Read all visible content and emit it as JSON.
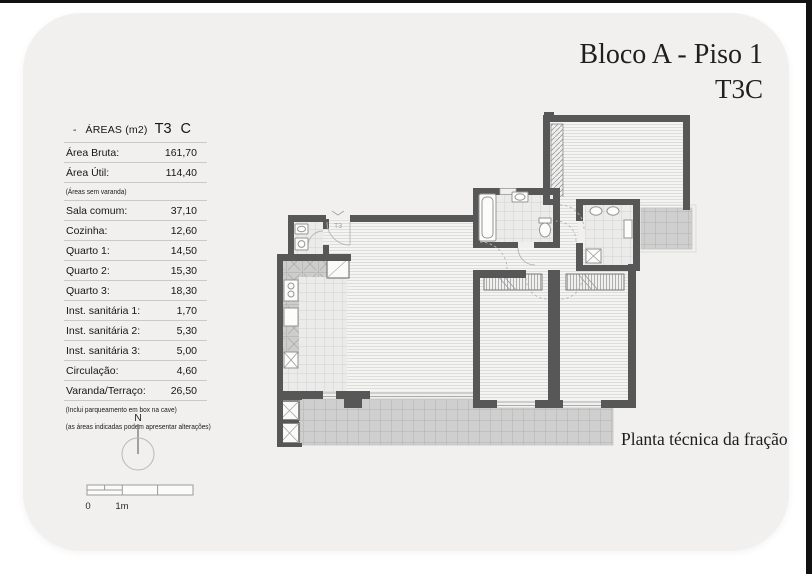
{
  "header": {
    "title_line1": "Bloco A - Piso 1",
    "title_line2": "T3C"
  },
  "areas_table": {
    "dash": "-",
    "title": "ÁREAS (m2)",
    "type_code": "T3",
    "type_letter": "C",
    "rows": [
      {
        "label": "Área Bruta:",
        "value": "161,70"
      },
      {
        "label": "Área Útil:",
        "value": "114,40"
      },
      {
        "note": "(Áreas sem varanda)"
      },
      {
        "label": "Sala comum:",
        "value": "37,10"
      },
      {
        "label": "Cozinha:",
        "value": "12,60"
      },
      {
        "label": "Quarto 1:",
        "value": "14,50"
      },
      {
        "label": "Quarto 2:",
        "value": "15,30"
      },
      {
        "label": "Quarto 3:",
        "value": "18,30"
      },
      {
        "label": "Inst. sanitária 1:",
        "value": "1,70"
      },
      {
        "label": "Inst. sanitária 2:",
        "value": "5,30"
      },
      {
        "label": "Inst. sanitária 3:",
        "value": "5,00"
      },
      {
        "label": "Circulação:",
        "value": "4,60"
      },
      {
        "label": "Varanda/Terraço:",
        "value": "26,50"
      },
      {
        "note": "(Inclui parqueamento em box na cave)"
      },
      {
        "note": "(as áreas indicadas podem apresentar alterações)"
      }
    ]
  },
  "compass": {
    "north_label": "N"
  },
  "scalebar": {
    "zero_label": "0",
    "meter_label": "1m"
  },
  "plan": {
    "caption": "Planta técnica da fração",
    "entrance_label": "T3"
  },
  "colors": {
    "card_background": "#f1f0ef",
    "wall": "#575757",
    "floor_hatch": "#dddddc",
    "tile_dark": "#cfcfcf",
    "tile_light": "#ebebea"
  }
}
